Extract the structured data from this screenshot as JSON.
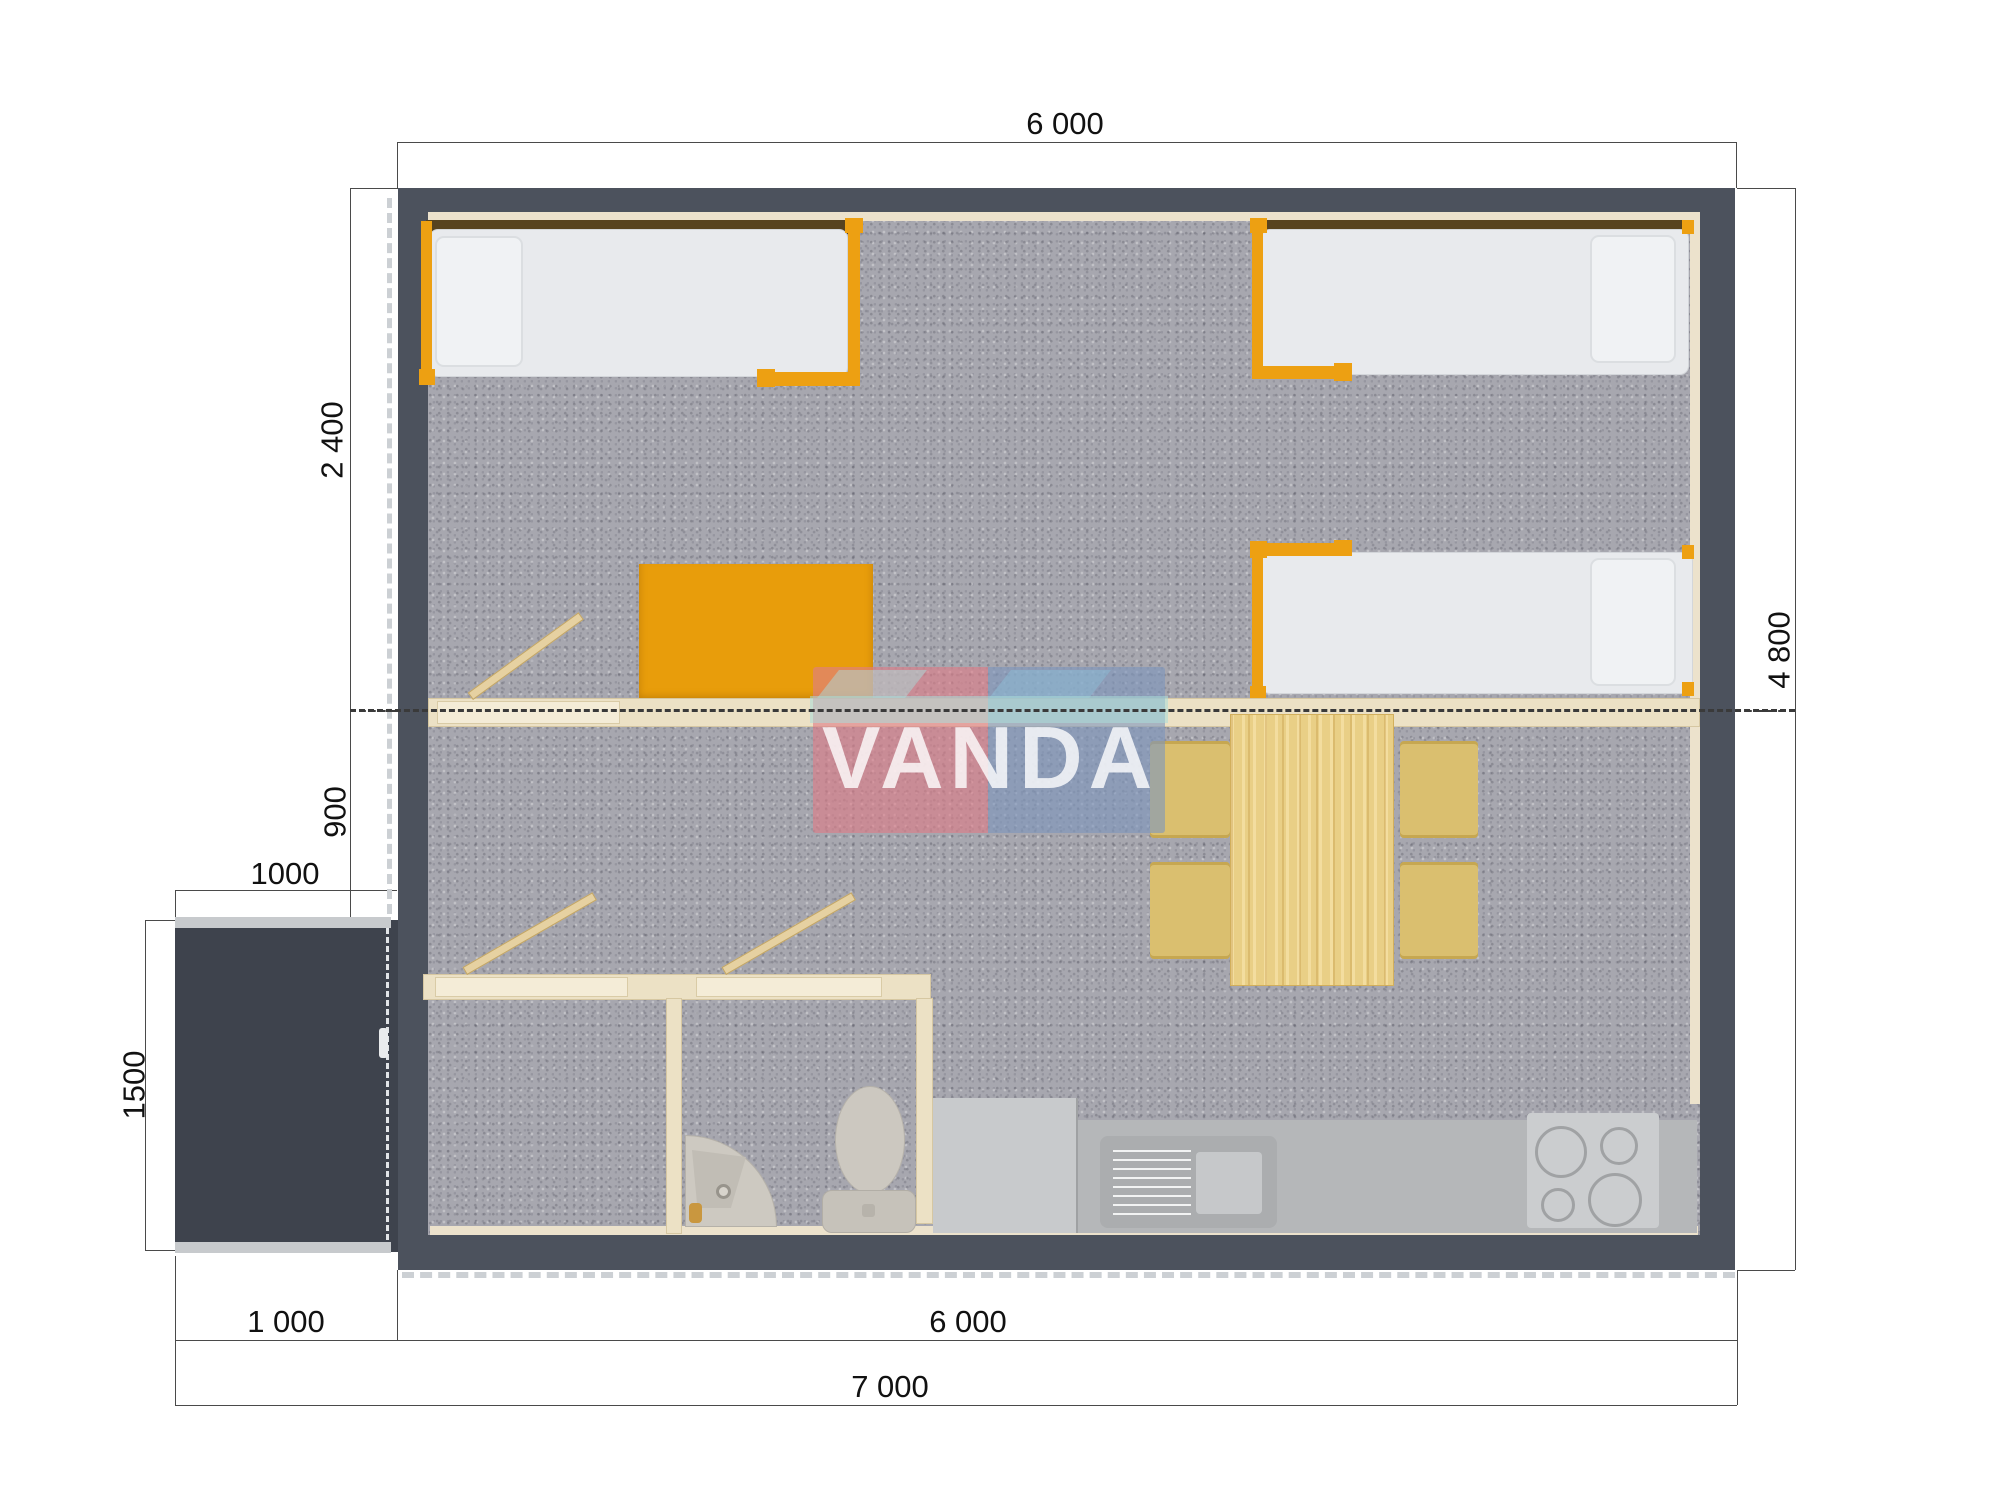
{
  "watermark": {
    "text": "VANDA",
    "colors": {
      "pink": "#df7d88",
      "blue": "#7e96bd",
      "teal": "#a9dcd9",
      "text": "#ffffff"
    }
  },
  "dimensions": {
    "top_width": "6 000",
    "bedroom_depth": "2 400",
    "entry_depth": "900",
    "porch_width_top": "1000",
    "porch_depth": "1500",
    "total_depth": "4 800",
    "porch_width_bottom": "1 000",
    "main_width_bottom": "6 000",
    "total_width": "7 000"
  },
  "colors": {
    "exterior_wall": "#4c525d",
    "porch": "#3e434d",
    "interior_wall": "#ece1c5",
    "carpet": "#a7a7af",
    "accent_orange": "#eda012",
    "wood": "#e9cf86",
    "counter": "#b5b7b9"
  },
  "plan": {
    "items": [
      "single-bed",
      "single-bed",
      "single-bed",
      "wardrobe",
      "dining-table",
      "chair",
      "chair",
      "chair",
      "chair",
      "kitchen-counter",
      "kitchen-sink",
      "stove",
      "toilet",
      "washbasin",
      "porch",
      "entrance-door",
      "interior-door",
      "interior-door",
      "interior-door"
    ]
  }
}
